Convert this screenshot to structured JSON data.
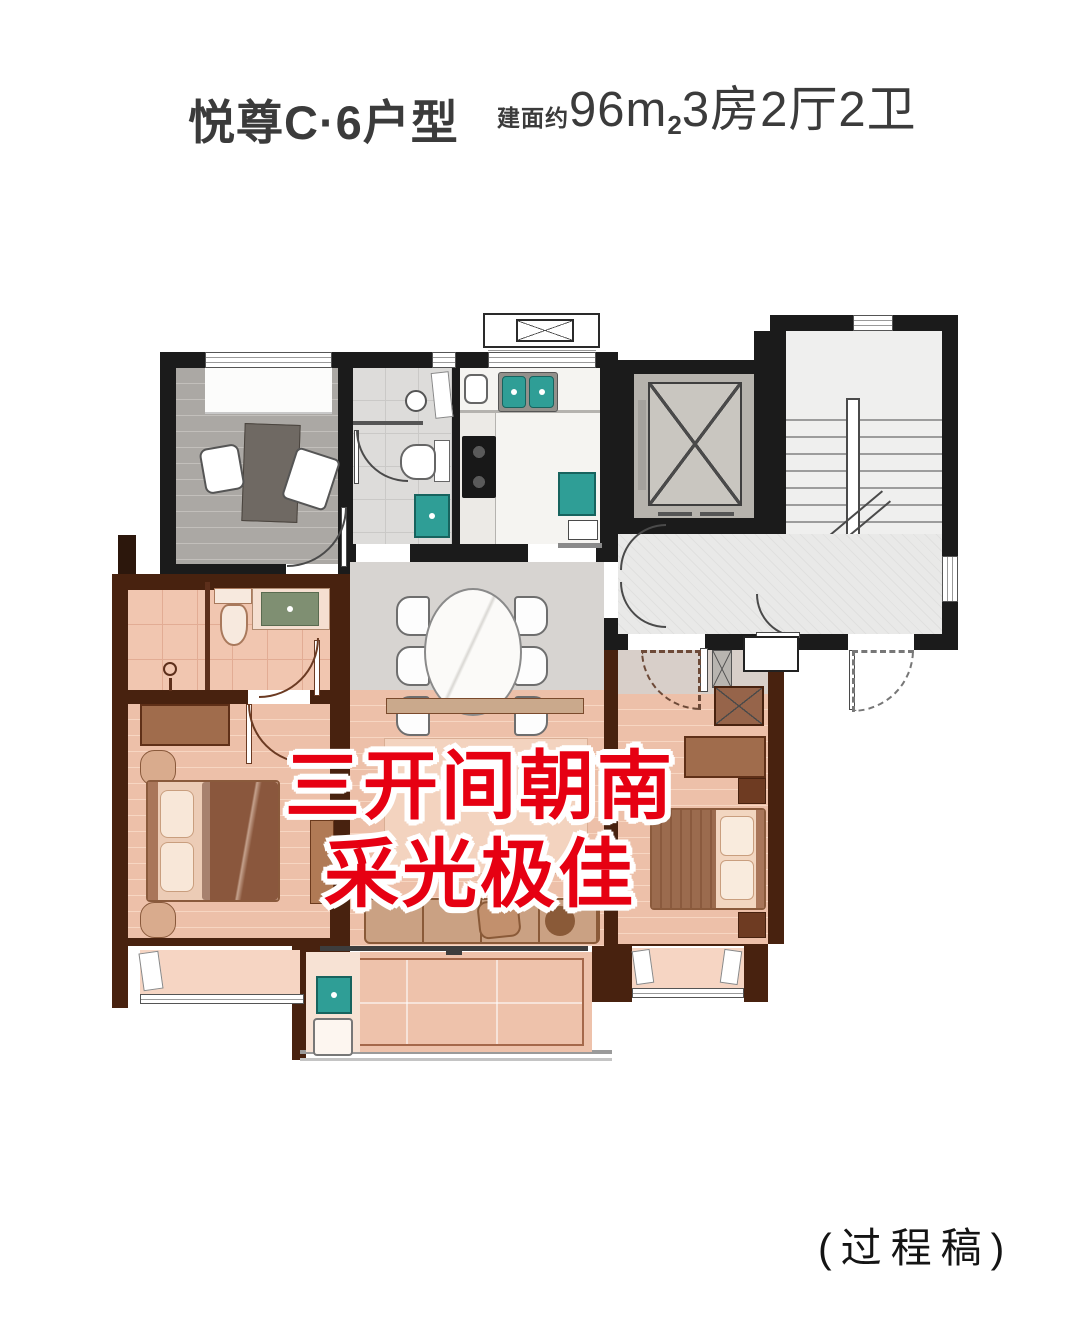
{
  "header": {
    "title": "悦尊C·6户型",
    "area_prefix": "建面约",
    "area_number": "96",
    "area_unit_m": "m",
    "area_unit_sup": "2",
    "spec": "3房2厅2卫"
  },
  "overlay": {
    "line1": "三开间朝南",
    "line2": "采光极佳"
  },
  "footer": {
    "draft_note": "(过程稿)"
  },
  "palette": {
    "accent_red": "#e60012",
    "title_gray": "#3b3b3b",
    "wall_black": "#1b1b1b",
    "wall_brown": "#48220f",
    "highlight_pink": "#edc0a9",
    "fixture_teal": "#2f9e96",
    "vanity_sage": "#7f8f72"
  }
}
